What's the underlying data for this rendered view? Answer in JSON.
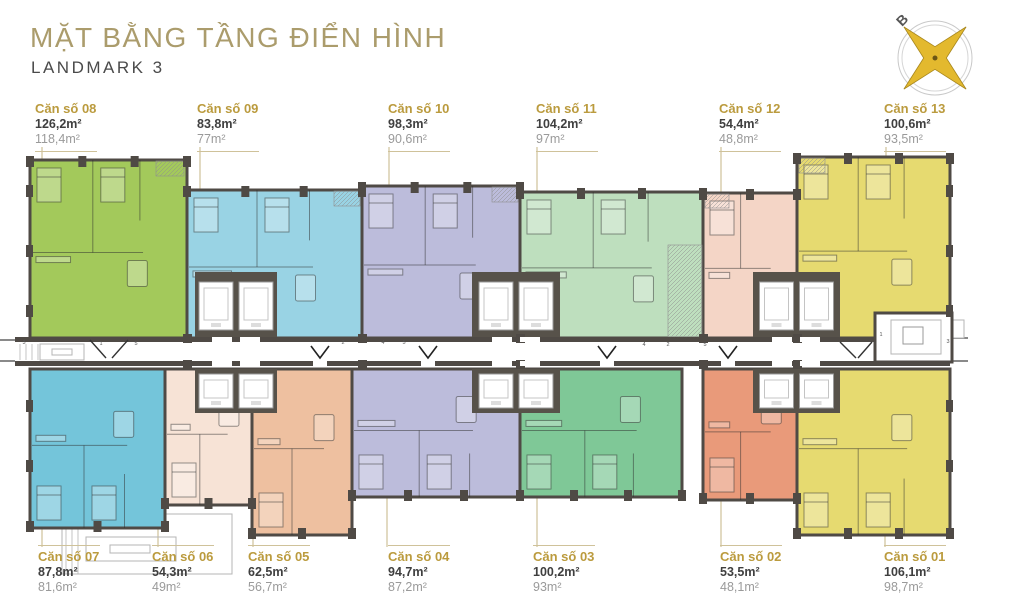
{
  "header": {
    "title": "MẶT BẰNG TẦNG ĐIỂN HÌNH",
    "subtitle": "LANDMARK 3"
  },
  "compass": {
    "north_label": "B"
  },
  "palette": {
    "label_gold": "#bb9b3e",
    "line_gold": "#cfc29a",
    "title_gold": "#ab9c6c",
    "wall": "#4f4a45"
  },
  "units_top": [
    {
      "id": "08",
      "name": "Căn số 08",
      "gross_area": "126,2m²",
      "net_area": "118,4m²",
      "color": "#a3c95b"
    },
    {
      "id": "09",
      "name": "Căn số 09",
      "gross_area": "83,8m²",
      "net_area": "77m²",
      "color": "#99d3e4"
    },
    {
      "id": "10",
      "name": "Căn số 10",
      "gross_area": "98,3m²",
      "net_area": "90,6m²",
      "color": "#bcbcdb"
    },
    {
      "id": "11",
      "name": "Căn số 11",
      "gross_area": "104,2m²",
      "net_area": "97m²",
      "color": "#bedfbe"
    },
    {
      "id": "12",
      "name": "Căn số 12",
      "gross_area": "54,4m²",
      "net_area": "48,8m²",
      "color": "#f4d5c6"
    },
    {
      "id": "13",
      "name": "Căn số 13",
      "gross_area": "100,6m²",
      "net_area": "93,5m²",
      "color": "#e6da70"
    }
  ],
  "units_bottom": [
    {
      "id": "07",
      "name": "Căn số 07",
      "gross_area": "87,8m²",
      "net_area": "81,6m²",
      "color": "#74c5da"
    },
    {
      "id": "06",
      "name": "Căn số 06",
      "gross_area": "54,3m²",
      "net_area": "49m²",
      "color": "#f7e3d6"
    },
    {
      "id": "05",
      "name": "Căn số 05",
      "gross_area": "62,5m²",
      "net_area": "56,7m²",
      "color": "#eec0a0"
    },
    {
      "id": "04",
      "name": "Căn số 04",
      "gross_area": "94,7m²",
      "net_area": "87,2m²",
      "color": "#bcbcdb"
    },
    {
      "id": "03",
      "name": "Căn số 03",
      "gross_area": "100,2m²",
      "net_area": "93m²",
      "color": "#7fc897"
    },
    {
      "id": "02",
      "name": "Căn số 02",
      "gross_area": "53,5m²",
      "net_area": "48,1m²",
      "color": "#e99a7a"
    },
    {
      "id": "01",
      "name": "Căn số 01",
      "gross_area": "106,1m²",
      "net_area": "98,7m²",
      "color": "#e6da70"
    }
  ],
  "floorplan": {
    "corridor_markers": [
      {
        "t": "3",
        "x": 24,
        "y": 344
      },
      {
        "t": "1",
        "x": 101,
        "y": 345
      },
      {
        "t": "5",
        "x": 136,
        "y": 345
      },
      {
        "t": "2",
        "x": 343,
        "y": 344
      },
      {
        "t": "4",
        "x": 383,
        "y": 344
      },
      {
        "t": "5",
        "x": 404,
        "y": 344
      },
      {
        "t": "4",
        "x": 644,
        "y": 346
      },
      {
        "t": "2",
        "x": 668,
        "y": 346
      },
      {
        "t": "5",
        "x": 705,
        "y": 346
      },
      {
        "t": "1",
        "x": 881,
        "y": 336
      },
      {
        "t": "3",
        "x": 948,
        "y": 343
      }
    ]
  }
}
